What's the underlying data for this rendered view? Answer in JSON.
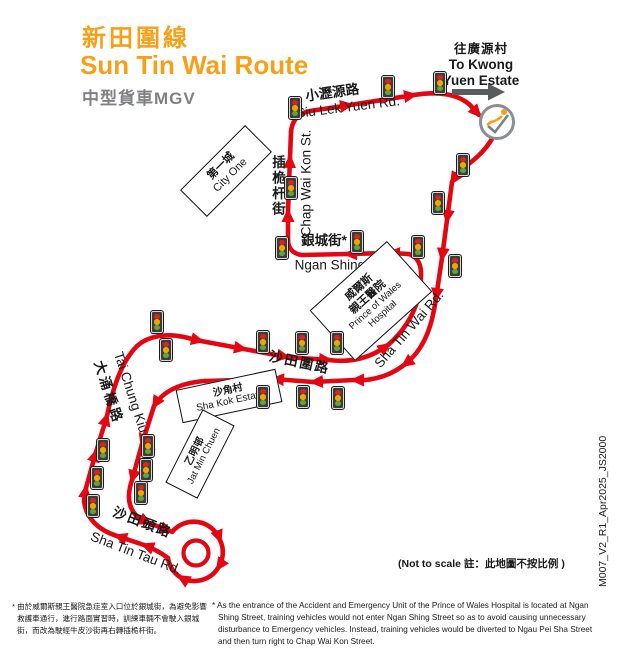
{
  "title": {
    "zh": "新田圍線",
    "en": "Sun Tin Wai Route",
    "vehicle": "中型貨車MGV"
  },
  "destination": {
    "zh": "往廣源村",
    "en_line1": "To Kwong",
    "en_line2": "Yuen Estate"
  },
  "roads": {
    "siu_lek_yuen": {
      "zh": "小瀝源路",
      "en": "Siu Lek Yuen Rd."
    },
    "chap_wai_kon": {
      "zh": "插桅杆街",
      "en": "Chap Wai Kon St."
    },
    "ngan_shing": {
      "zh": "銀城街*",
      "en": "Ngan Shing St."
    },
    "sha_tin_wai": {
      "zh": "沙田圍路",
      "en": "Sha Tin Wai Rd."
    },
    "tai_chung_kiu": {
      "zh": "大涌橋路",
      "en": "Tai Chung Kiu Rd."
    },
    "sha_tin_tau": {
      "zh": "沙田頭路",
      "en": "Sha Tin Tau Rd."
    }
  },
  "places": {
    "city_one": {
      "zh": "第一城",
      "en": "City One"
    },
    "hospital": {
      "zh1": "威爾斯",
      "zh2": "親王醫院",
      "en1": "Prince of Wales",
      "en2": "Hospital"
    },
    "sha_kok": {
      "zh": "沙角村",
      "en": "Sha Kok Estate"
    },
    "jat_min": {
      "zh": "乙明邨",
      "en": "Jat Min Chuen"
    }
  },
  "notes": {
    "not_to_scale": "(Not to scale 註：此地圖不按比例 )",
    "doc_id": "M007_V2_R1_Apr2025_JS2000",
    "footnote_zh": "* 由於威爾斯親王醫院急症室入口位於銀城街，為避免影響救護車通行，進行路面實習時，訓練車輛不會駛入銀城街，而改為駛經牛皮沙街再右轉插桅杆街。",
    "footnote_en": "* As the entrance of the Accident and Emergency Unit of the Prince of Wales Hospital is located at Ngan Shing Street, training vehicles would not enter Ngan Shing Street so as to avoid causing unnecessary disturbance to Emergency vehicles. Instead, training vehicles would be diverted to Ngau Pei Sha Street and then turn right to Chap Wai Kon Street."
  },
  "colors": {
    "route_red": "#e30613",
    "title_orange": "#f6a01a",
    "subtitle_grey": "#7f8184",
    "dest_arrow_grey": "#595b5d",
    "light_red": "#d9261c",
    "light_amber": "#f0a500",
    "light_green": "#61a437"
  },
  "map": {
    "traffic_lights": [
      {
        "x": 295,
        "y": 108
      },
      {
        "x": 388,
        "y": 87
      },
      {
        "x": 440,
        "y": 83
      },
      {
        "x": 463,
        "y": 165
      },
      {
        "x": 438,
        "y": 203
      },
      {
        "x": 418,
        "y": 247
      },
      {
        "x": 455,
        "y": 266
      },
      {
        "x": 291,
        "y": 188
      },
      {
        "x": 282,
        "y": 248
      },
      {
        "x": 357,
        "y": 242
      },
      {
        "x": 157,
        "y": 322
      },
      {
        "x": 166,
        "y": 350
      },
      {
        "x": 263,
        "y": 342
      },
      {
        "x": 302,
        "y": 343
      },
      {
        "x": 337,
        "y": 343
      },
      {
        "x": 263,
        "y": 397
      },
      {
        "x": 303,
        "y": 397
      },
      {
        "x": 338,
        "y": 398
      },
      {
        "x": 103,
        "y": 450
      },
      {
        "x": 148,
        "y": 446
      },
      {
        "x": 97,
        "y": 478
      },
      {
        "x": 146,
        "y": 470
      },
      {
        "x": 93,
        "y": 506
      },
      {
        "x": 141,
        "y": 493
      }
    ]
  }
}
